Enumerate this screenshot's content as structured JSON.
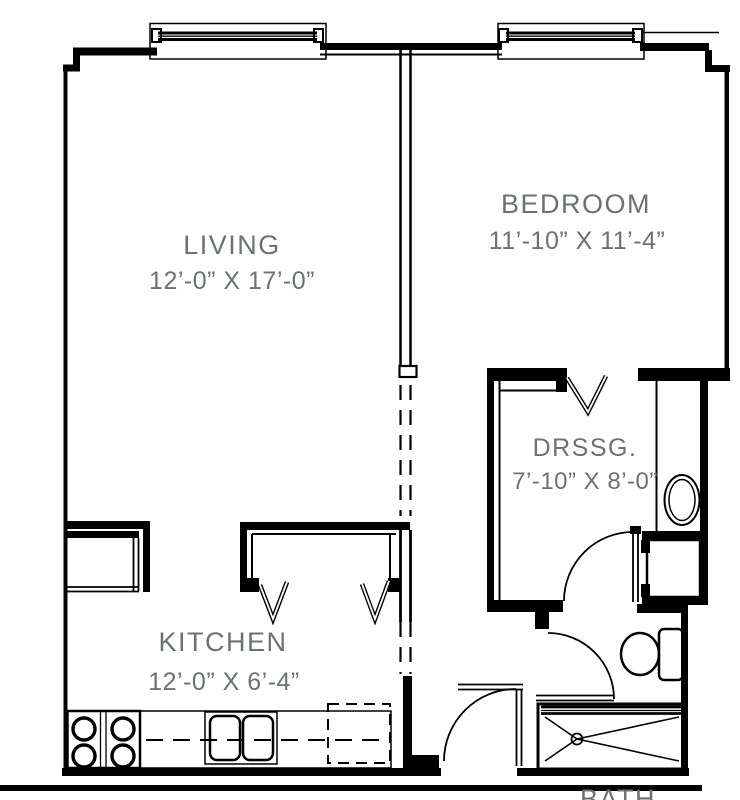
{
  "floor_plan": {
    "background": "#ffffff",
    "wall_color": "#000000",
    "label_color": "#6c7175",
    "rooms": [
      {
        "name": "LIVING",
        "dimensions": "12’-0” X 17’-0”"
      },
      {
        "name": "BEDROOM",
        "dimensions": "11’-10” X 11’-4”"
      },
      {
        "name": "KITCHEN",
        "dimensions": "12’-0” X 6’-4”"
      },
      {
        "name": "DRSSG.",
        "dimensions": "7’-10” X 8’-0”"
      },
      {
        "name": "BATH",
        "dimensions": ""
      }
    ],
    "fixtures": [
      "range",
      "double-sink",
      "dishwasher",
      "refrigerator-closet",
      "linen-closet",
      "vanity-sink",
      "toilet",
      "shower"
    ],
    "windows": 2,
    "doors": 3
  }
}
